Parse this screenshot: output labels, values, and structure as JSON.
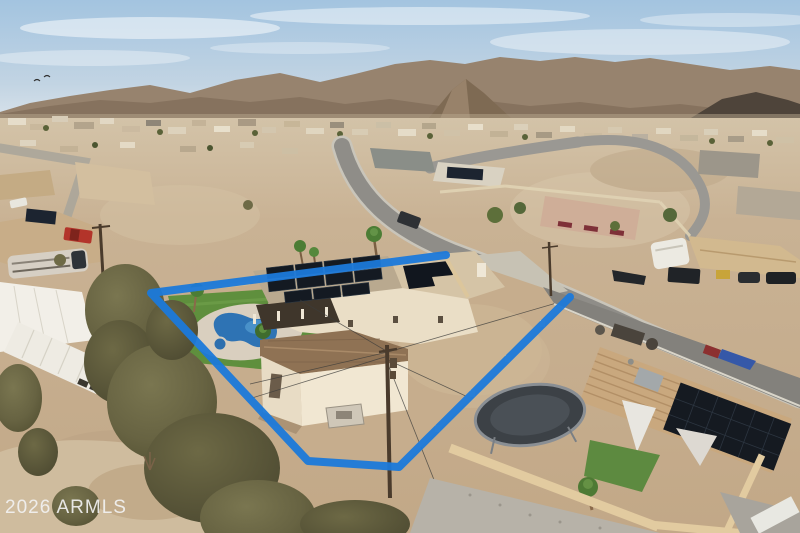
{
  "image": {
    "type": "aerial-drone-photo",
    "subject": "single-story desert home with rooftop solar, kidney pool, turf lawn and detached garage, outlined by a blue property-boundary overlay",
    "setting": "suburban desert neighborhood with mountain range on the horizon"
  },
  "watermark": {
    "text": "2026 ARMLS"
  },
  "colors": {
    "boundary": "#1b79da",
    "sky_top": "#a3c4e0",
    "sky_horizon": "#d8e2ea",
    "mountains": "#8a7664",
    "desert_ground": "#c8b193",
    "turf": "#5f8f3d",
    "pool": "#2e73b4",
    "solar_panel": "#141a22",
    "house_wall": "#ecdfc8",
    "road": "#8f8d88",
    "wall_tan": "#dcc69c",
    "watermark_text": "#f2f2f2"
  },
  "features": [
    "blue property boundary outline with gap at driveway",
    "main house with two rooftop solar arrays",
    "covered patio",
    "kidney-shaped swimming pool with spa",
    "artificial turf lawn with palm trees",
    "detached garage with brown shingle roof",
    "wooden utility pole with wires",
    "white enclosed cargo trailer",
    "class-A motorhome",
    "neighboring tile-roof house with solar panels and shade sails",
    "trampoline",
    "curving asphalt streets",
    "desert brush and gravel yards",
    "mountain range and conical hill on horizon",
    "two birds in the sky"
  ]
}
